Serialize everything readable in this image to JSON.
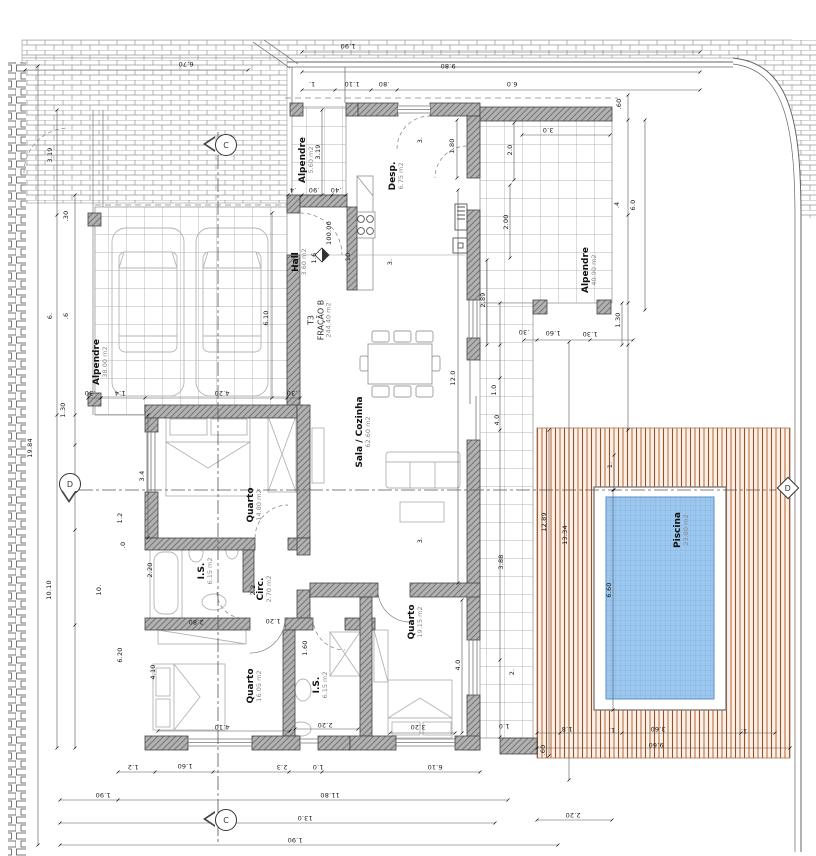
{
  "drawing_title": "Planta - Fração B (T3)",
  "fraction": {
    "line1": "T3",
    "line2": "FRAÇÃO B",
    "line3": "244.40 m2"
  },
  "colors": {
    "pool_water": "#9cc7ef",
    "pool_grid": "#76a9d9",
    "deck_wood": "#c0713f",
    "deck_wood_dark": "#96512a",
    "wall_fill": "#b2b2b2",
    "wall_hatch": "#757575",
    "tile_line": "#9a9a9a",
    "paving_line": "#979797",
    "furniture_line": "#b4b4b4"
  },
  "rooms": [
    {
      "name": "Alpendre",
      "area": "38.00 m2",
      "x": 101,
      "y": 362
    },
    {
      "name": "Alpendre",
      "area": "5.60 m2",
      "x": 307,
      "y": 160
    },
    {
      "name": "Desp.",
      "area": "6.75 m2",
      "x": 397,
      "y": 176
    },
    {
      "name": "Hall",
      "area": "3.60 m2",
      "x": 300,
      "y": 262
    },
    {
      "name": "Sala / Cozinha",
      "area": "62.60 m2",
      "x": 364,
      "y": 432
    },
    {
      "name": "Quarto",
      "area": "14.80 m2",
      "x": 255,
      "y": 505
    },
    {
      "name": "I.S.",
      "area": "6.15 m2",
      "x": 206,
      "y": 571
    },
    {
      "name": "Circ.",
      "area": "2.70 m2",
      "x": 265,
      "y": 589
    },
    {
      "name": "Quarto",
      "area": "16.05 m2",
      "x": 255,
      "y": 686
    },
    {
      "name": "I.S.",
      "area": "6.15 m2",
      "x": 321,
      "y": 685
    },
    {
      "name": "Quarto",
      "area": "19.15 m2",
      "x": 416,
      "y": 622
    },
    {
      "name": "Alpendre",
      "area": "40.90 m2",
      "x": 590,
      "y": 270
    },
    {
      "name": "Piscina",
      "area": "23.80 m2",
      "x": 682,
      "y": 530
    }
  ],
  "section_markers": [
    {
      "letter": "C",
      "x": 226,
      "y": 145,
      "shape": "tri-left"
    },
    {
      "letter": "C",
      "x": 226,
      "y": 820,
      "shape": "tri-left"
    },
    {
      "letter": "D",
      "x": 70,
      "y": 484,
      "shape": "tri-down"
    },
    {
      "letter": "D",
      "x": 788,
      "y": 488,
      "shape": "diamond"
    }
  ],
  "dims": [
    {
      "t": "1.90",
      "x": 348,
      "y": 46,
      "r": 180
    },
    {
      "t": "9.80",
      "x": 448,
      "y": 66,
      "r": 180
    },
    {
      "t": "1.",
      "x": 312,
      "y": 84,
      "r": 180
    },
    {
      "t": "1.10",
      "x": 352,
      "y": 84,
      "r": 180
    },
    {
      "t": ".80",
      "x": 384,
      "y": 84,
      "r": 180
    },
    {
      "t": "6.0",
      "x": 512,
      "y": 84,
      "r": 180
    },
    {
      "t": "6.70",
      "x": 186,
      "y": 64,
      "r": 180
    },
    {
      "t": "19.84",
      "x": 30,
      "y": 448
    },
    {
      "t": "3.19",
      "x": 50,
      "y": 155
    },
    {
      "t": ".30",
      "x": 66,
      "y": 216
    },
    {
      "t": "6.",
      "x": 50,
      "y": 316
    },
    {
      "t": ".6",
      "x": 66,
      "y": 316
    },
    {
      "t": "1.30",
      "x": 63,
      "y": 410
    },
    {
      "t": "10.10",
      "x": 49,
      "y": 590
    },
    {
      "t": "10.",
      "x": 99,
      "y": 590
    },
    {
      "t": "1.2",
      "x": 120,
      "y": 518
    },
    {
      "t": ".0",
      "x": 123,
      "y": 545
    },
    {
      "t": "6.20",
      "x": 120,
      "y": 655
    },
    {
      "t": "6.10",
      "x": 266,
      "y": 318
    },
    {
      "t": "4.20",
      "x": 222,
      "y": 393,
      "r": 180
    },
    {
      "t": "1.4",
      "x": 120,
      "y": 393,
      "r": 180
    },
    {
      "t": ".30",
      "x": 90,
      "y": 393,
      "r": 180
    },
    {
      "t": ".30",
      "x": 292,
      "y": 393,
      "r": 180
    },
    {
      "t": "3.19",
      "x": 318,
      "y": 152
    },
    {
      "t": ".4",
      "x": 293,
      "y": 190,
      "r": 180
    },
    {
      "t": ".90",
      "x": 314,
      "y": 190,
      "r": 180
    },
    {
      "t": ".40",
      "x": 336,
      "y": 190,
      "r": 180
    },
    {
      "t": "3.",
      "x": 420,
      "y": 140
    },
    {
      "t": "1.80",
      "x": 452,
      "y": 146
    },
    {
      "t": "1.6",
      "x": 314,
      "y": 258
    },
    {
      "t": "100.00",
      "x": 329,
      "y": 233
    },
    {
      "t": ".10",
      "x": 348,
      "y": 258
    },
    {
      "t": "3.",
      "x": 390,
      "y": 262
    },
    {
      "t": "12.0",
      "x": 453,
      "y": 378
    },
    {
      "t": "3.",
      "x": 420,
      "y": 540
    },
    {
      "t": "3.4",
      "x": 142,
      "y": 476
    },
    {
      "t": "2.20",
      "x": 150,
      "y": 570
    },
    {
      "t": "2.2",
      "x": 253,
      "y": 590
    },
    {
      "t": "1.60",
      "x": 305,
      "y": 648
    },
    {
      "t": "2.80",
      "x": 196,
      "y": 622,
      "r": 180
    },
    {
      "t": "1.20",
      "x": 273,
      "y": 621,
      "r": 180
    },
    {
      "t": "4.10",
      "x": 153,
      "y": 672
    },
    {
      "t": "4.10",
      "x": 222,
      "y": 727,
      "r": 180
    },
    {
      "t": "2.20",
      "x": 325,
      "y": 725,
      "r": 180
    },
    {
      "t": "3.20",
      "x": 418,
      "y": 727,
      "r": 180
    },
    {
      "t": "4.0",
      "x": 458,
      "y": 665
    },
    {
      "t": ".60",
      "x": 619,
      "y": 104
    },
    {
      "t": "3.0",
      "x": 548,
      "y": 130,
      "r": 180
    },
    {
      "t": "2.0",
      "x": 510,
      "y": 150
    },
    {
      "t": "2.00",
      "x": 506,
      "y": 222
    },
    {
      "t": "2.89",
      "x": 483,
      "y": 300
    },
    {
      "t": ".4",
      "x": 617,
      "y": 205
    },
    {
      "t": "6.0",
      "x": 633,
      "y": 205
    },
    {
      "t": "1.30",
      "x": 618,
      "y": 320
    },
    {
      "t": ".30",
      "x": 524,
      "y": 332,
      "r": 180
    },
    {
      "t": "1.60",
      "x": 553,
      "y": 333,
      "r": 180
    },
    {
      "t": "1.30",
      "x": 590,
      "y": 334,
      "r": 180
    },
    {
      "t": "1.0",
      "x": 494,
      "y": 390
    },
    {
      "t": "4.0",
      "x": 497,
      "y": 420
    },
    {
      "t": "3.88",
      "x": 501,
      "y": 562
    },
    {
      "t": "2.",
      "x": 512,
      "y": 672
    },
    {
      "t": "1.0",
      "x": 504,
      "y": 726,
      "r": 180
    },
    {
      "t": "12.89",
      "x": 544,
      "y": 522
    },
    {
      "t": "13.34",
      "x": 565,
      "y": 535
    },
    {
      "t": "1.",
      "x": 610,
      "y": 465
    },
    {
      "t": "6.60",
      "x": 609,
      "y": 590
    },
    {
      "t": ".60",
      "x": 543,
      "y": 750
    },
    {
      "t": "1.8",
      "x": 567,
      "y": 729,
      "r": 180
    },
    {
      "t": "1.",
      "x": 612,
      "y": 730,
      "r": 180
    },
    {
      "t": "3.60",
      "x": 658,
      "y": 729,
      "r": 180
    },
    {
      "t": "1.",
      "x": 744,
      "y": 731,
      "r": 180
    },
    {
      "t": "9.60",
      "x": 656,
      "y": 745,
      "r": 180
    },
    {
      "t": "2.20",
      "x": 573,
      "y": 815,
      "r": 180
    },
    {
      "t": "1.2",
      "x": 133,
      "y": 767,
      "r": 180
    },
    {
      "t": "1.60",
      "x": 185,
      "y": 766,
      "r": 180
    },
    {
      "t": "2.3",
      "x": 282,
      "y": 767,
      "r": 180
    },
    {
      "t": "1.0",
      "x": 318,
      "y": 767,
      "r": 180
    },
    {
      "t": "6.10",
      "x": 435,
      "y": 767,
      "r": 180
    },
    {
      "t": "1.90",
      "x": 103,
      "y": 795,
      "r": 180
    },
    {
      "t": "11.80",
      "x": 330,
      "y": 795,
      "r": 180
    },
    {
      "t": "13.0",
      "x": 305,
      "y": 818,
      "r": 180
    },
    {
      "t": "1.90",
      "x": 295,
      "y": 840,
      "r": 180
    }
  ]
}
